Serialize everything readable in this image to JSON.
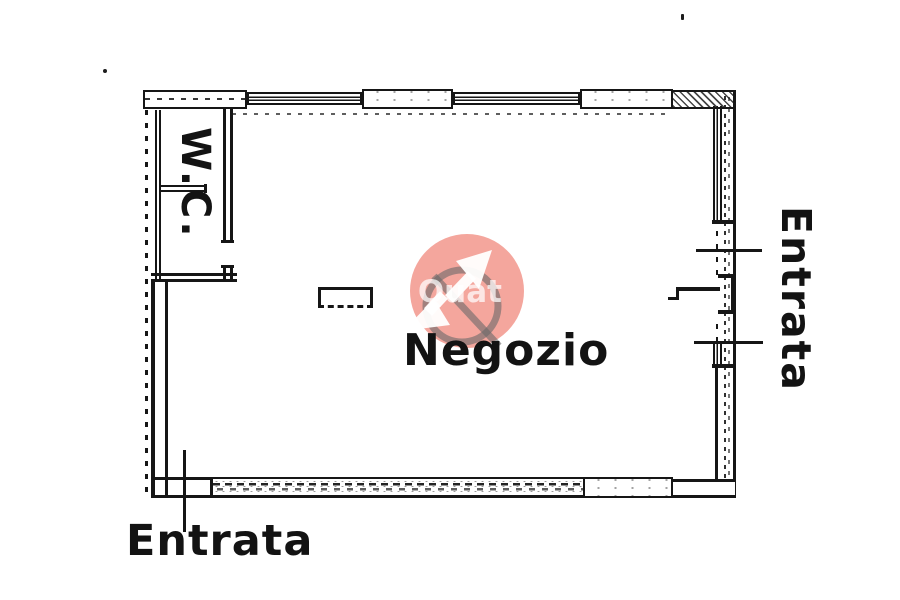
{
  "labels": {
    "room": "Negozio",
    "wc": "W.C.",
    "entrance_right": "Entrata",
    "entrance_bottom": "Entrata"
  },
  "watermark": {
    "text_fragment": "e Quat",
    "circle_fill": "rgba(233,70,50,0.48)",
    "ring_stroke": "rgba(105,105,105,0.6)",
    "arrow_fill": "rgba(255,255,255,0.95)",
    "text_fill": "rgba(255,255,255,0.72)"
  }
}
